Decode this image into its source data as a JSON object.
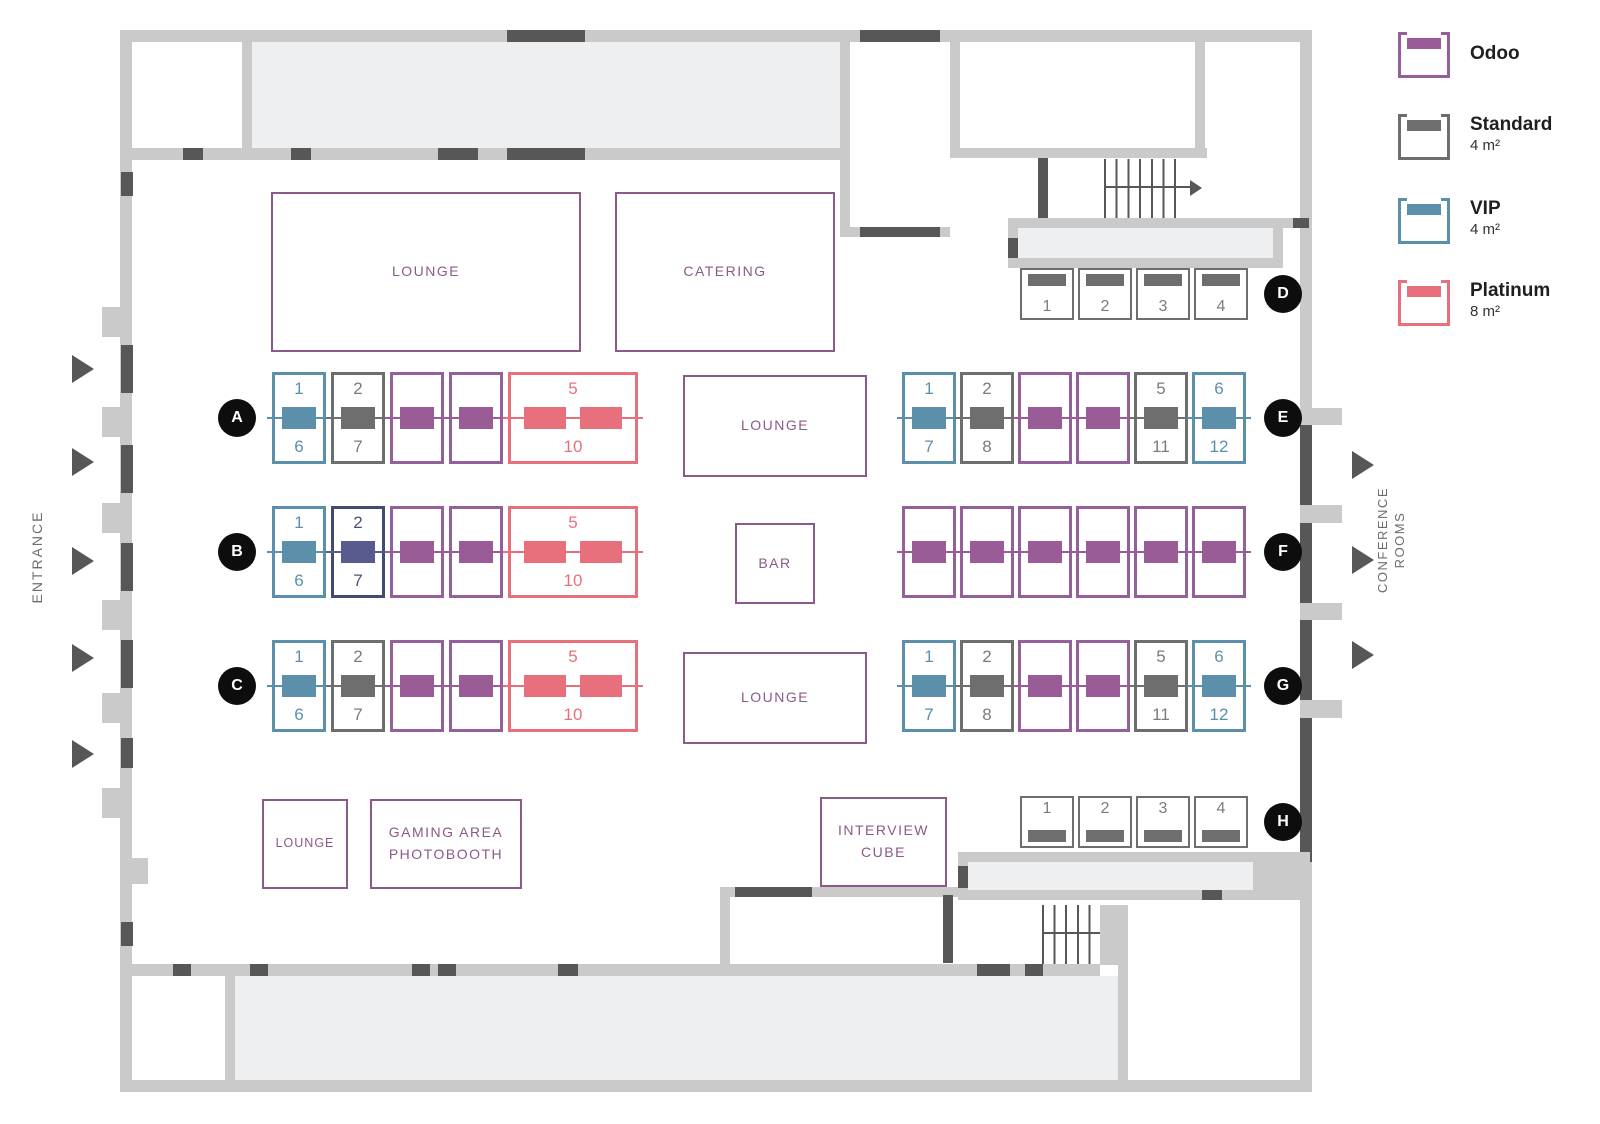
{
  "legend": {
    "items": [
      {
        "name": "odoo",
        "label": "Odoo",
        "sub": "",
        "border": "#94609A",
        "fill": "#9A5C96"
      },
      {
        "name": "standard",
        "label": "Standard",
        "sub": "4 m²",
        "border": "#6E6E6E",
        "fill": "#6E6E6E"
      },
      {
        "name": "vip",
        "label": "VIP",
        "sub": "4 m²",
        "border": "#5C90AA",
        "fill": "#5C90AA"
      },
      {
        "name": "platinum",
        "label": "Platinum",
        "sub": "8 m²",
        "border": "#E8707D",
        "fill": "#E8707D"
      }
    ]
  },
  "booth_types": {
    "odoo": {
      "fill": "#9A5C96",
      "border": "#94609A",
      "text": "#9A5C96"
    },
    "standard": {
      "fill": "#6E6E6E",
      "border": "#6E6E6E",
      "text": "#7B7B7B"
    },
    "vip": {
      "fill": "#5C90AA",
      "border": "#5C90AA",
      "text": "#5C90AA"
    },
    "platinum": {
      "fill": "#E8707D",
      "border": "#E8707D",
      "text": "#E8707D"
    },
    "navy": {
      "fill": "#575B8D",
      "border": "#454A70",
      "text": "#4C5080"
    }
  },
  "rows": {
    "A": {
      "label": "A",
      "kind": "v",
      "booths": [
        {
          "type": "vip",
          "top": "1",
          "bottom": "6"
        },
        {
          "type": "standard",
          "top": "2",
          "bottom": "7"
        },
        {
          "type": "odoo"
        },
        {
          "type": "odoo"
        },
        {
          "type": "platinum",
          "top": "5",
          "bottom": "10",
          "wide": true
        }
      ]
    },
    "B": {
      "label": "B",
      "kind": "v",
      "booths": [
        {
          "type": "vip",
          "top": "1",
          "bottom": "6"
        },
        {
          "type": "navy",
          "top": "2",
          "bottom": "7"
        },
        {
          "type": "odoo"
        },
        {
          "type": "odoo"
        },
        {
          "type": "platinum",
          "top": "5",
          "bottom": "10",
          "wide": true
        }
      ]
    },
    "C": {
      "label": "C",
      "kind": "v",
      "booths": [
        {
          "type": "vip",
          "top": "1",
          "bottom": "6"
        },
        {
          "type": "standard",
          "top": "2",
          "bottom": "7"
        },
        {
          "type": "odoo"
        },
        {
          "type": "odoo"
        },
        {
          "type": "platinum",
          "top": "5",
          "bottom": "10",
          "wide": true
        }
      ]
    },
    "D": {
      "label": "D",
      "kind": "h",
      "bar": "top",
      "booths": [
        {
          "type": "standard",
          "num": "1"
        },
        {
          "type": "standard",
          "num": "2"
        },
        {
          "type": "standard",
          "num": "3"
        },
        {
          "type": "standard",
          "num": "4"
        }
      ]
    },
    "E": {
      "label": "E",
      "kind": "v",
      "booths": [
        {
          "type": "vip",
          "top": "1",
          "bottom": "7"
        },
        {
          "type": "standard",
          "top": "2",
          "bottom": "8"
        },
        {
          "type": "odoo"
        },
        {
          "type": "odoo"
        },
        {
          "type": "standard",
          "top": "5",
          "bottom": "11"
        },
        {
          "type": "vip",
          "top": "6",
          "bottom": "12"
        }
      ]
    },
    "F": {
      "label": "F",
      "kind": "v",
      "booths": [
        {
          "type": "odoo"
        },
        {
          "type": "odoo"
        },
        {
          "type": "odoo"
        },
        {
          "type": "odoo"
        },
        {
          "type": "odoo"
        },
        {
          "type": "odoo"
        }
      ]
    },
    "G": {
      "label": "G",
      "kind": "v",
      "booths": [
        {
          "type": "vip",
          "top": "1",
          "bottom": "7"
        },
        {
          "type": "standard",
          "top": "2",
          "bottom": "8"
        },
        {
          "type": "odoo"
        },
        {
          "type": "odoo"
        },
        {
          "type": "standard",
          "top": "5",
          "bottom": "11"
        },
        {
          "type": "vip",
          "top": "6",
          "bottom": "12"
        }
      ]
    },
    "H": {
      "label": "H",
      "kind": "h",
      "bar": "bottom",
      "booths": [
        {
          "type": "standard",
          "num": "1"
        },
        {
          "type": "standard",
          "num": "2"
        },
        {
          "type": "standard",
          "num": "3"
        },
        {
          "type": "standard",
          "num": "4"
        }
      ]
    }
  },
  "areas": {
    "lounge_top": "LOUNGE",
    "catering": "CATERING",
    "lounge_mid": "LOUNGE",
    "bar": "BAR",
    "lounge_bottom": "LOUNGE",
    "lounge_small": "LOUNGE",
    "gaming_line1": "GAMING AREA",
    "gaming_line2": "PHOTOBOOTH",
    "interview_line1": "INTERVIEW",
    "interview_line2": "CUBE"
  },
  "side_labels": {
    "entrance": "ENTRANCE",
    "conference_line1": "CONFERENCE",
    "conference_line2": "ROOMS"
  },
  "colors": {
    "wall": "#CACACA",
    "door": "#575757",
    "room_fill": "#EDEFF0",
    "venue_label": "#8A5A88",
    "row_circle": "#0D0D0D",
    "side_text": "#6D6D6D"
  }
}
